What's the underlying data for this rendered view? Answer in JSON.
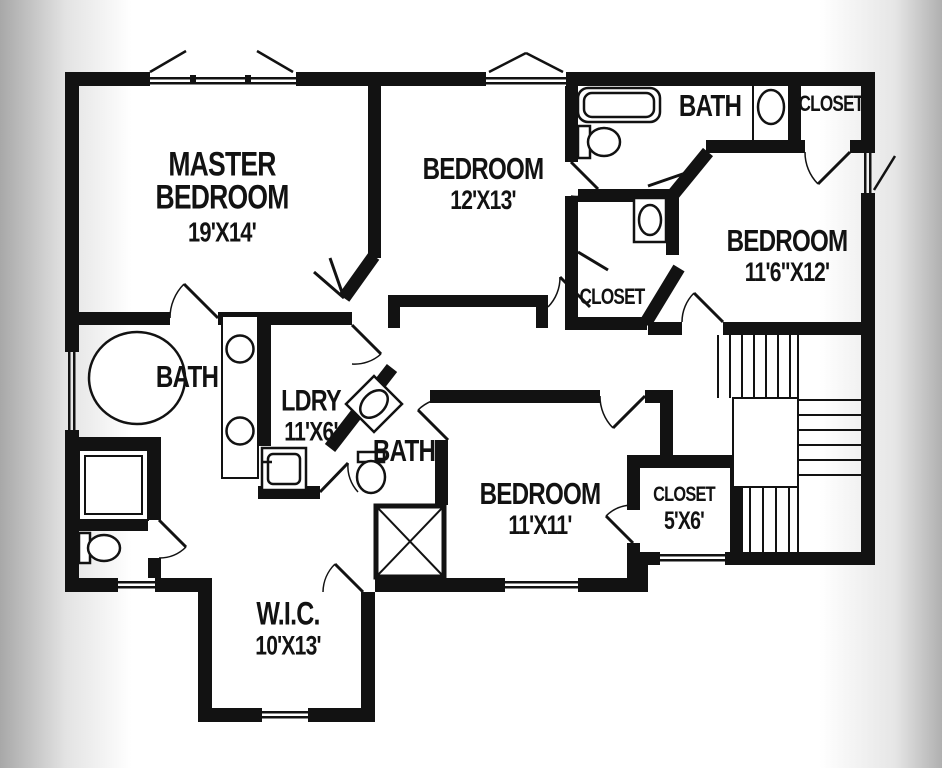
{
  "canvas": {
    "ink": "#121212",
    "paper": "#ffffff",
    "edge_shade": "#a8a8a8"
  },
  "rooms": [
    {
      "id": "master-bedroom",
      "label": "MASTER BEDROOM",
      "dims": "19'X14'"
    },
    {
      "id": "bedroom-top",
      "label": "BEDROOM",
      "dims": "12'X13'"
    },
    {
      "id": "bath-hall",
      "label": "BATH",
      "dims": ""
    },
    {
      "id": "closet-top-right",
      "label": "CLOSET",
      "dims": ""
    },
    {
      "id": "bedroom-right",
      "label": "BEDROOM",
      "dims": "11'6\"X12'"
    },
    {
      "id": "closet-hall",
      "label": "CLOSET",
      "dims": ""
    },
    {
      "id": "bath-master",
      "label": "BATH",
      "dims": ""
    },
    {
      "id": "laundry",
      "label": "LDRY",
      "dims": "11'X6'"
    },
    {
      "id": "bath-middle",
      "label": "BATH",
      "dims": ""
    },
    {
      "id": "bedroom-bottom",
      "label": "BEDROOM",
      "dims": "11'X11'"
    },
    {
      "id": "closet-bottom",
      "label": "CLOSET",
      "dims": "5'X6'"
    },
    {
      "id": "walk-in-closet",
      "label": "W.I.C.",
      "dims": "10'X13'"
    }
  ],
  "fixtures": [
    "bathtub",
    "toilet",
    "oval-sink",
    "double-vanity",
    "oval-tub",
    "washer",
    "corner-sink",
    "shower-stall",
    "staircase",
    "attic-chase",
    "window"
  ]
}
